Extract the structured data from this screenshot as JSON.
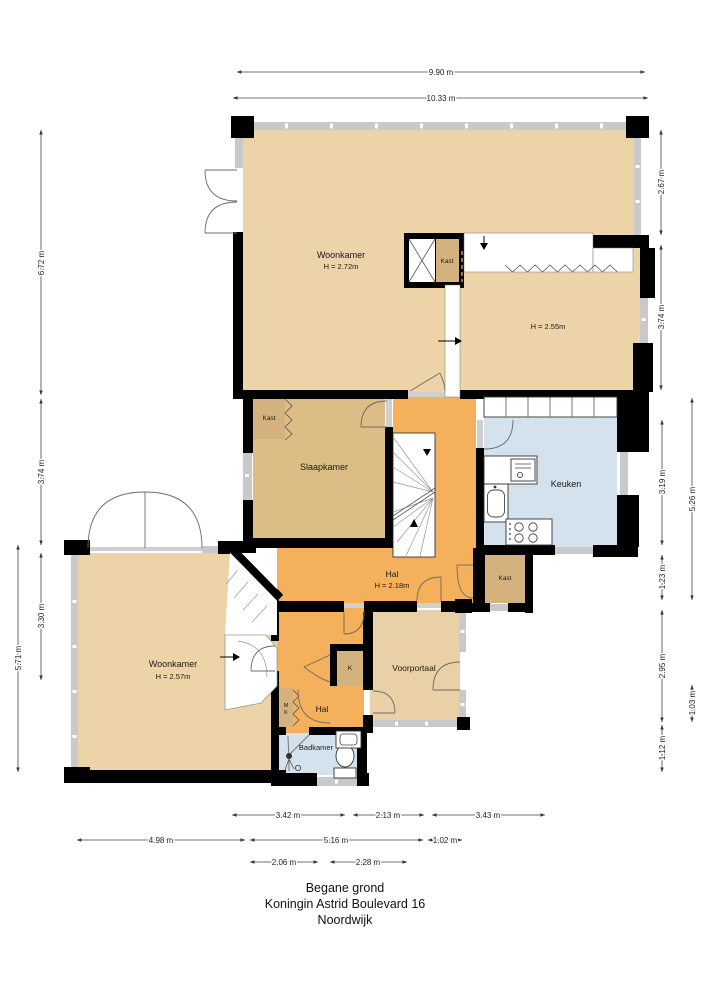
{
  "title": {
    "line1": "Begane grond",
    "line2": "Koningin Astrid Boulevard 16",
    "line3": "Noordwijk"
  },
  "labels": {
    "woonkamer": "Woonkamer",
    "woonkamer_top_h": "H = 2.72m",
    "room_right_h": "H = 2.55m",
    "kast": "Kast",
    "slaapkamer": "Slaapkamer",
    "keuken": "Keuken",
    "hal": "Hal",
    "hal_h": "H = 2.18m",
    "woonkamer_lower_h": "H = 2.57m",
    "voorportaal": "Voorportaal",
    "k": "K",
    "m": "M",
    "badkamer": "Badkamer"
  },
  "dims": {
    "top_inner": "9.90 m",
    "top_outer": "10.33 m",
    "left_1": "6.72 m",
    "left_2": "3.74 m",
    "left_3": "3.30 m",
    "left_outer": "5.71 m",
    "right_1": "2.67 m",
    "right_2": "3.74 m",
    "right_3": "3.19 m",
    "right_outer_top": "5.26 m",
    "right_4": "1.23 m",
    "right_5": "2.95 m",
    "right_outer_bottom": "1.03 m",
    "right_6": "1.12 m",
    "bottom_row1": [
      "3.42 m",
      "2.13 m",
      "3.43 m"
    ],
    "bottom_row2": [
      "4.98 m",
      "5.16 m",
      "1.02 m"
    ],
    "bottom_row3": [
      "2.06 m",
      "2.28 m"
    ]
  },
  "colors": {
    "room_light": "#edd3a8",
    "room_mid": "#dcbd85",
    "room_kast": "#d3b27e",
    "hall_orange": "#f4b05a",
    "wet_blue": "#d4e2ee",
    "wall": "#000000",
    "glass": "#c9c9c9"
  }
}
